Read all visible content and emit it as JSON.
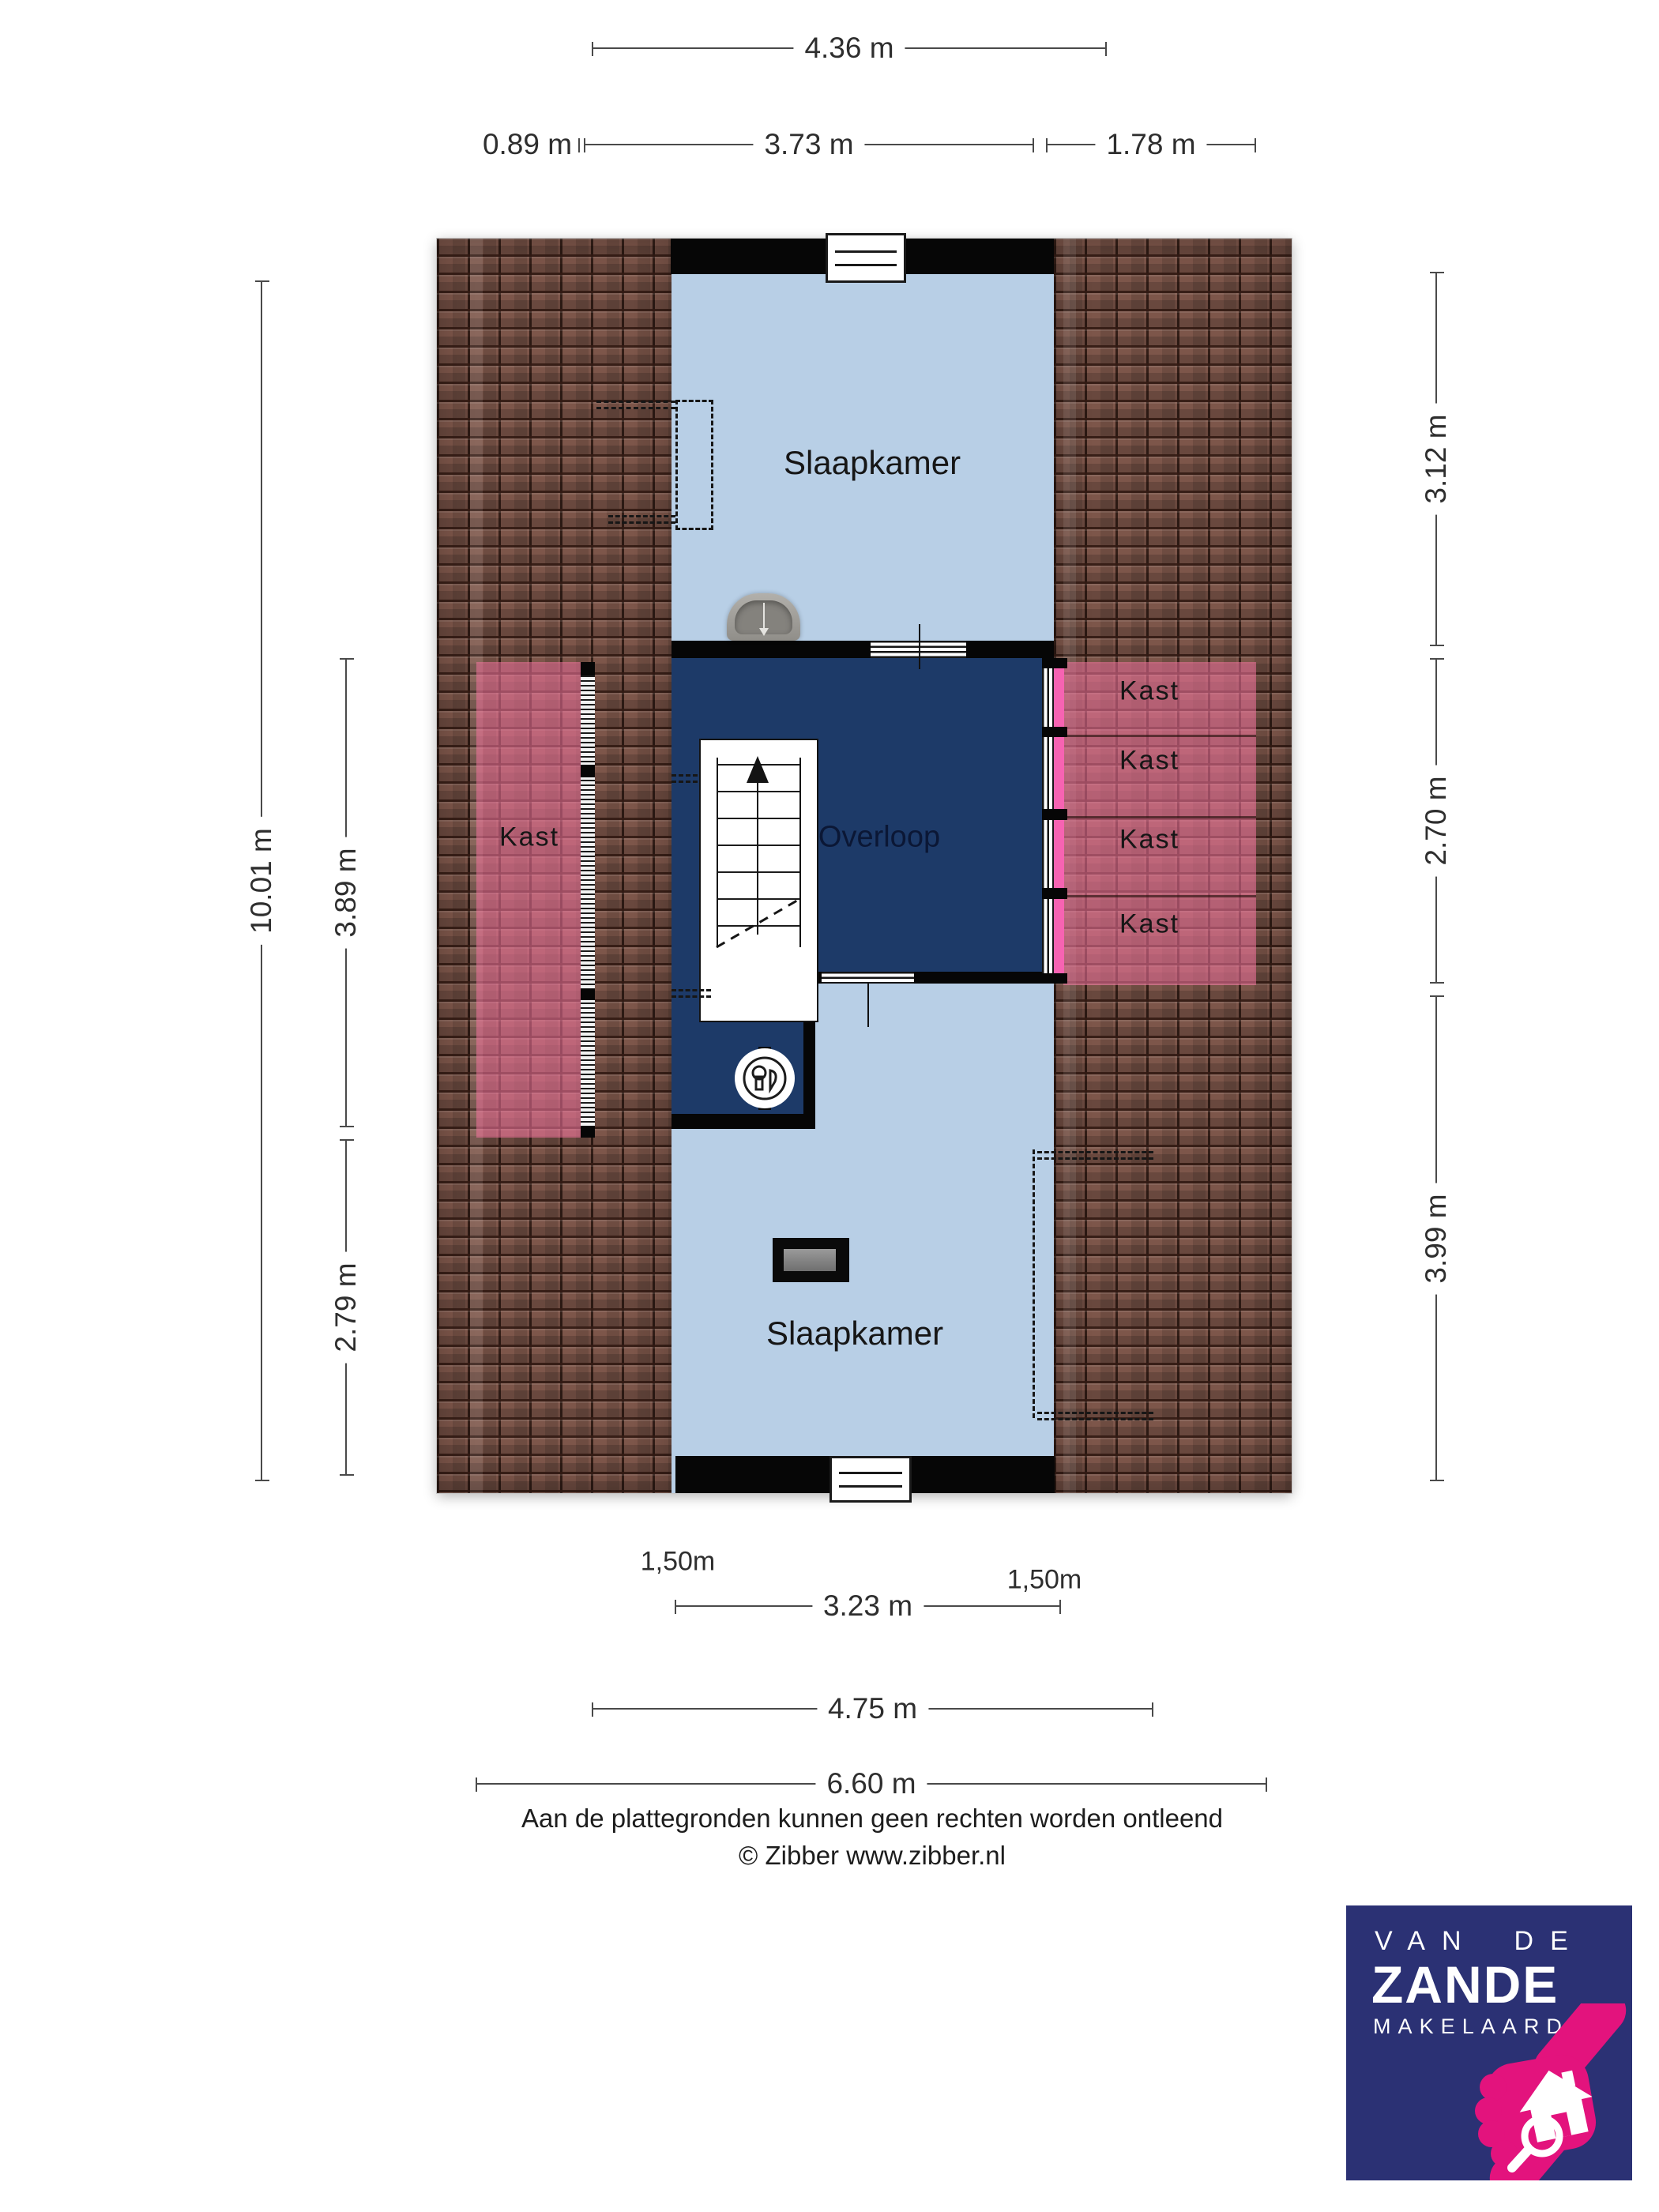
{
  "dimensions": {
    "top_total": "4.36 m",
    "top_left": "0.89 m",
    "top_middle": "3.73 m",
    "top_right": "1.78 m",
    "left_total": "10.01 m",
    "left_upper": "3.89 m",
    "left_lower": "2.79 m",
    "right_top": "3.12 m",
    "right_middle": "2.70 m",
    "right_bottom": "3.99 m",
    "roof_left_height": "1,50m",
    "roof_right_height": "1,50m",
    "bottom_inner": "3.23 m",
    "bottom_middle": "4.75 m",
    "bottom_total": "6.60 m"
  },
  "rooms": {
    "bedroom_top": "Slaapkamer",
    "landing": "Overloop",
    "bedroom_bottom": "Slaapkamer",
    "closet_left": "Kast",
    "closet_right_1": "Kast",
    "closet_right_2": "Kast",
    "closet_right_3": "Kast",
    "closet_right_4": "Kast"
  },
  "footer": {
    "disclaimer": "Aan de plattegronden kunnen geen rechten worden ontleend",
    "copyright": "© Zibber www.zibber.nl"
  },
  "logo": {
    "line1": "VAN DE",
    "line2": "ZANDE",
    "line3": "MAKELAARDIJ"
  },
  "colors": {
    "room_fill": "#b8cfe6",
    "landing_fill": "#1d3a68",
    "wall": "#060606",
    "roof_tile": "#7d564a",
    "closet_highlight": "#f274a0",
    "closet_door_accent": "#f763b2",
    "dimension_line": "#4a4a4a",
    "logo_background": "#2b3174",
    "logo_accent": "#e3137d"
  }
}
